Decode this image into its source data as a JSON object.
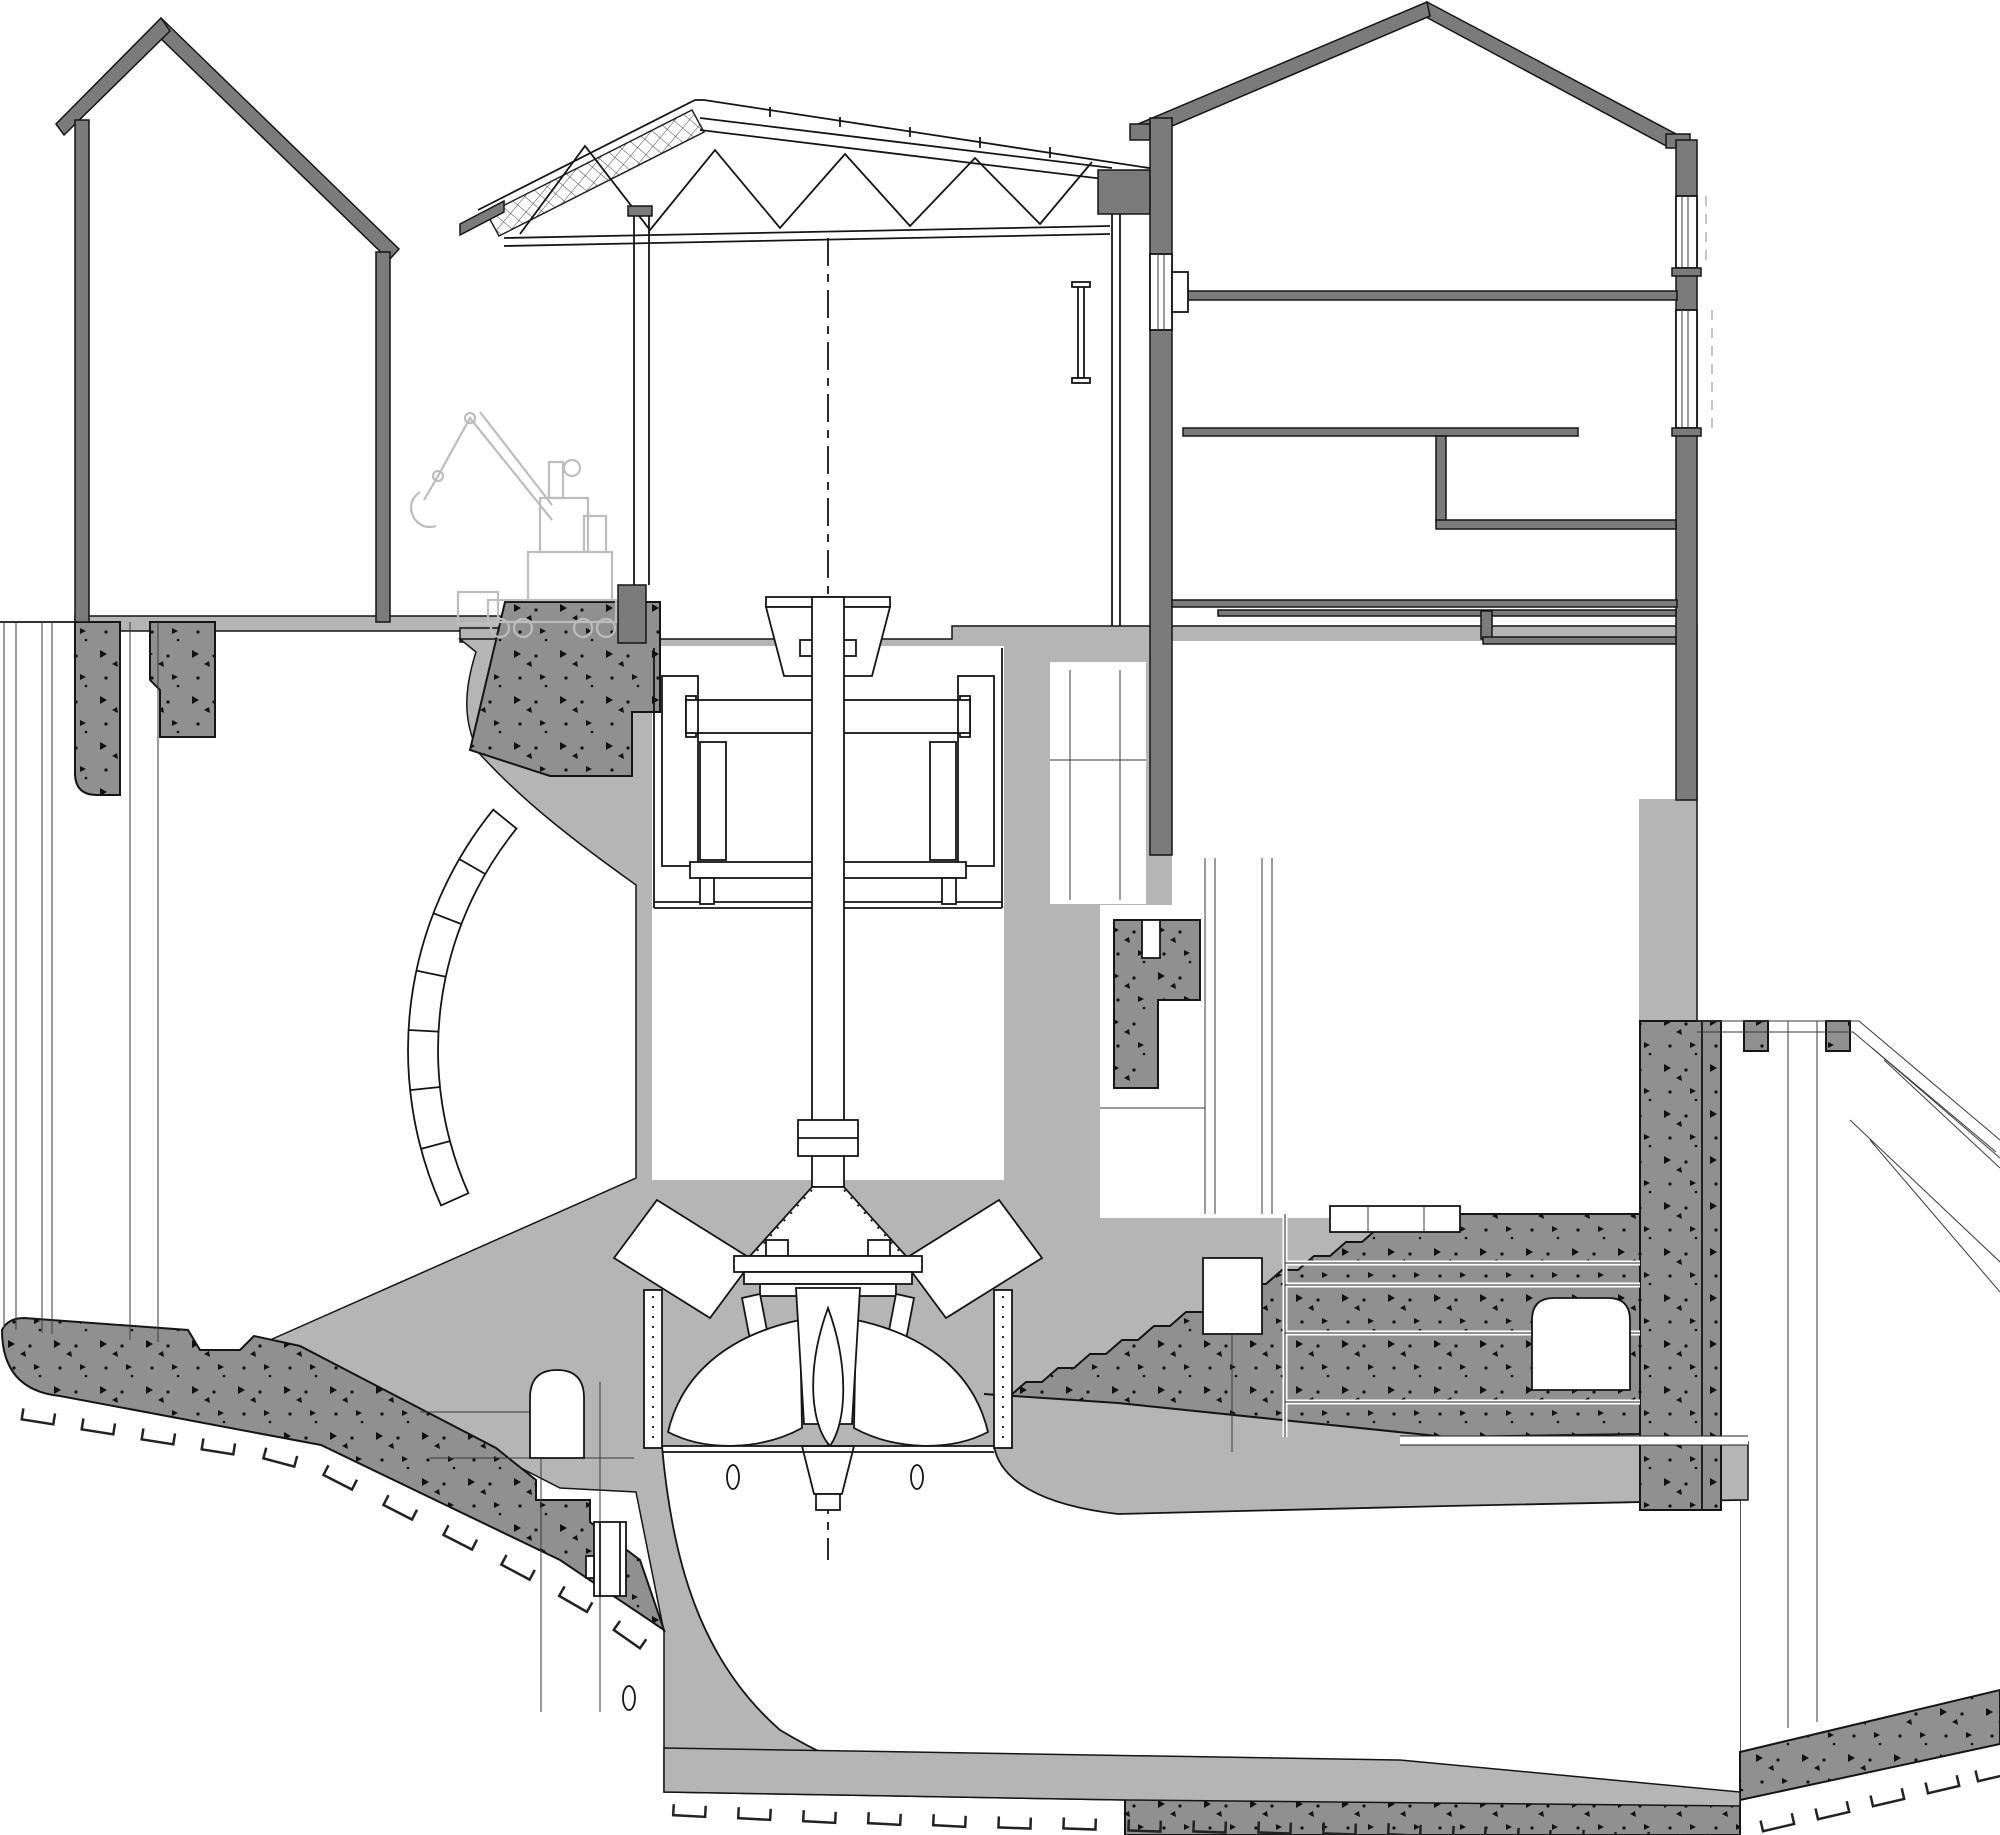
{
  "drawing": {
    "type": "engineering-section",
    "subject": "hydroelectric power station cross-section",
    "components": [
      "left-building",
      "machine-hall",
      "roof-truss",
      "mobile-crane-sketch",
      "right-building",
      "generator",
      "turbine-shaft",
      "kaplan-runner",
      "spiral-case",
      "draft-tube",
      "tailrace-channel",
      "access-arch",
      "stair-foundation",
      "rock-excavation-ticks",
      "riverbank-slope",
      "segmented-arc-wall",
      "sheet-pile-lines"
    ]
  },
  "colors": {
    "bg": "#ffffff",
    "wall": "#7b7b7b",
    "conc": "#b5b5b5",
    "speck": "#909090",
    "sketch": "#bdbdbd",
    "line": "#151515"
  }
}
